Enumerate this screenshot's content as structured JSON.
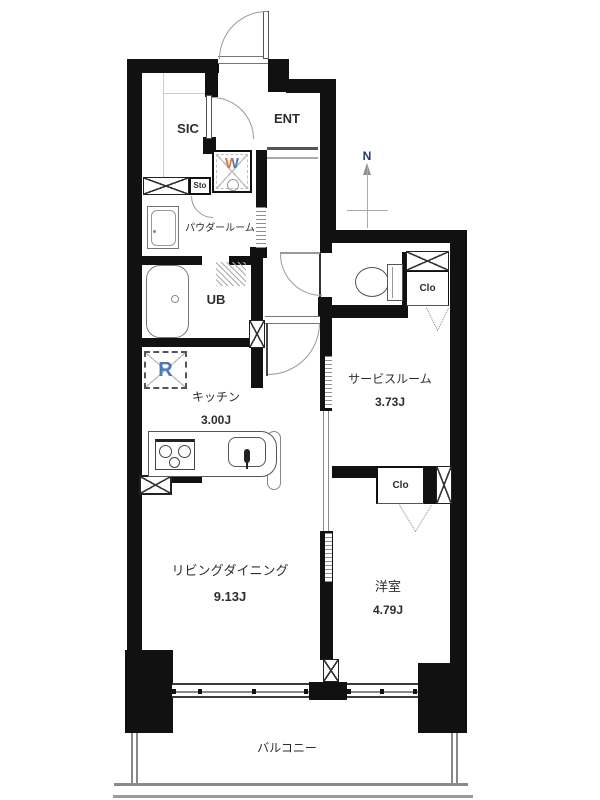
{
  "rooms": {
    "sic": {
      "label": "SIC"
    },
    "ent": {
      "label": "ENT"
    },
    "sto": {
      "label": "Sto"
    },
    "powder_room": {
      "label": "パウダールーム"
    },
    "unit_bath": {
      "label": "UB"
    },
    "kitchen": {
      "label": "キッチン",
      "size": "3.00J"
    },
    "service_room": {
      "label": "サービスルーム",
      "size": "3.73J"
    },
    "living_dining": {
      "label": "リビングダイニング",
      "size": "9.13J"
    },
    "western_room": {
      "label": "洋室",
      "size": "4.79J"
    },
    "balcony": {
      "label": "バルコニー"
    },
    "closet_service": {
      "label": "Clo"
    },
    "closet_western": {
      "label": "Clo"
    }
  },
  "fixtures": {
    "washer": {
      "label": "W"
    },
    "refrigerator": {
      "label": "R"
    }
  },
  "compass": {
    "north": "N"
  },
  "colors": {
    "wall": "#111111",
    "text": "#2e2e2e",
    "refrigerator_letter": "#4878b8",
    "washer_letter_left": "#d97a3c",
    "washer_letter_right": "#4878b8",
    "compass_north": "#22366b"
  }
}
